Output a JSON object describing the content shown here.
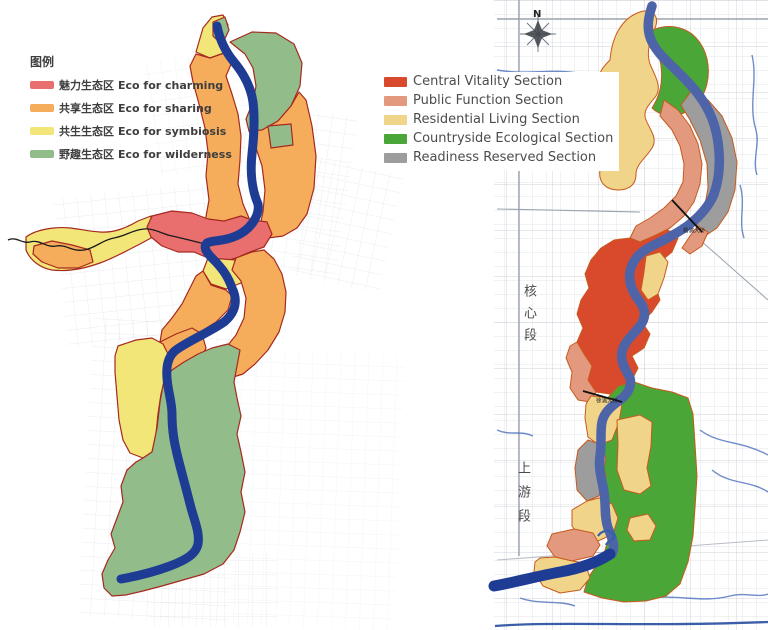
{
  "left_map": {
    "legend": {
      "title": "图例",
      "items": [
        {
          "zh": "魅力生态区",
          "en": "Eco for charming",
          "color": "#e96f6e"
        },
        {
          "zh": "共享生态区",
          "en": "Eco for sharing",
          "color": "#f5ad5b"
        },
        {
          "zh": "共生生态区",
          "en": "Eco for symbiosis",
          "color": "#f3e678"
        },
        {
          "zh": "野趣生态区",
          "en": "Eco for wilderness",
          "color": "#92bc8a"
        }
      ]
    }
  },
  "right_map": {
    "legend": {
      "items": [
        {
          "label": "Central Vitality Section",
          "color": "#d84a2b"
        },
        {
          "label": "Public Function Section",
          "color": "#e3997e"
        },
        {
          "label": "Residential Living Section",
          "color": "#f0d489"
        },
        {
          "label": "Countryside Ecological Section",
          "color": "#4aa637"
        },
        {
          "label": "Readiness Reserved Section",
          "color": "#9d9d9d"
        }
      ]
    },
    "north_label": "N",
    "section_labels": {
      "core": "核心段",
      "upstream": "上游段"
    },
    "bridge_labels": [
      {
        "text": "杨浦大桥"
      },
      {
        "text": "徐浦大桥"
      }
    ]
  },
  "colors": {
    "left_charming": "#e96f6e",
    "left_sharing": "#f5ad5b",
    "left_symbiosis": "#f3e678",
    "left_wilderness": "#92bc8a",
    "left_outline": "#a6291f",
    "right_vitality": "#d84a2b",
    "right_public": "#e3997e",
    "right_residential": "#f0d489",
    "right_ecological": "#4aa637",
    "right_reserved": "#9d9d9d",
    "right_outline": "#c75a1d",
    "river_left": "#1f3c94",
    "river_right": "#4e64a8",
    "canal": "#5578c0"
  }
}
